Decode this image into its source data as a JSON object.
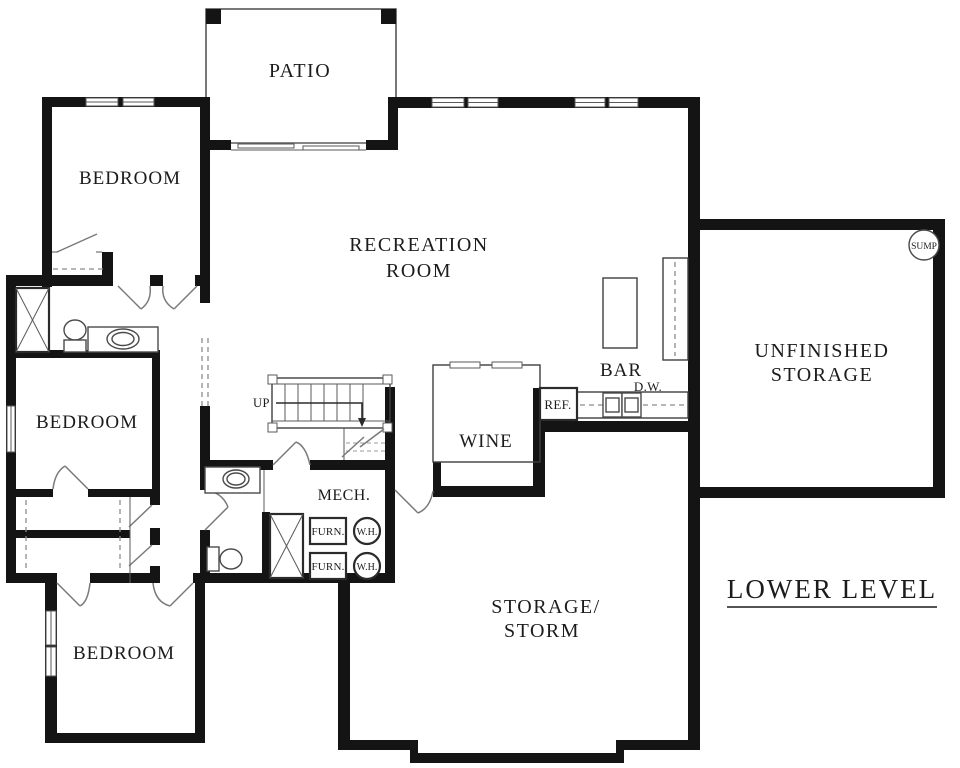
{
  "page": {
    "title": "Lower Level Floor Plan",
    "background": "#ffffff"
  },
  "plan": {
    "name_label": "LOWER LEVEL",
    "colors": {
      "wall": "#141414",
      "thin_line": "#3f3f3f",
      "dashed_line": "#8c8c8c",
      "text": "#1c1c1c",
      "background": "#ffffff"
    },
    "rooms": {
      "patio": {
        "label": "PATIO"
      },
      "bedroom_top": {
        "label": "BEDROOM"
      },
      "bedroom_middle": {
        "label": "BEDROOM"
      },
      "bedroom_bottom": {
        "label": "BEDROOM"
      },
      "recreation": {
        "line1": "RECREATION",
        "line2": "ROOM"
      },
      "unfinished_storage": {
        "line1": "UNFINISHED",
        "line2": "STORAGE"
      },
      "storage_storm": {
        "line1": "STORAGE/",
        "line2": "STORM"
      },
      "wine": {
        "label": "WINE"
      },
      "mech": {
        "label": "MECH."
      },
      "bar": {
        "label": "BAR"
      }
    },
    "equipment": {
      "stairs_up": "UP",
      "refrigerator": "REF.",
      "dishwasher": "D.W.",
      "furnace_top": "FURN.",
      "furnace_bottom": "FURN.",
      "water_heater_top": "W.H.",
      "water_heater_bottom": "W.H.",
      "sump_pump": "SUMP"
    }
  }
}
